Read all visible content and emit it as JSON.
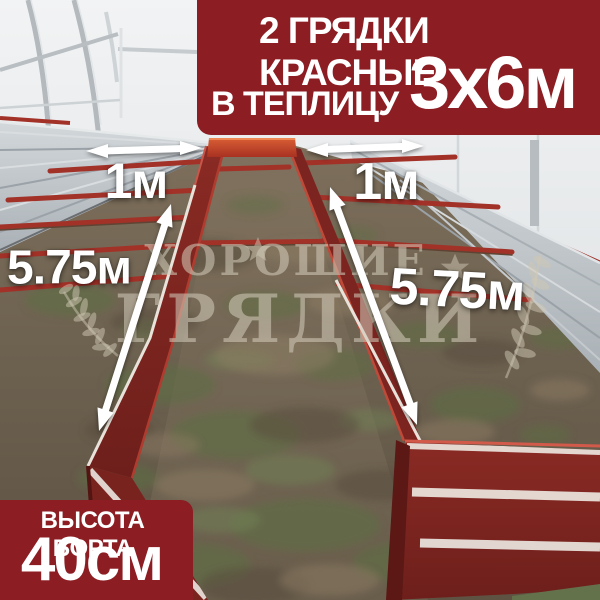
{
  "banner": {
    "line1": "2 ГРЯДКИ КРАСНЫЕ",
    "line2_prefix": "В ТЕПЛИЦУ",
    "line2_size": "3х6м",
    "bg_color": "#8c1d23",
    "text_color": "#ffffff"
  },
  "badge": {
    "line1": "ВЫСОТА БОРТА",
    "line2": "40см",
    "bg_color": "#8c1d23",
    "text_color": "#ffffff"
  },
  "measurements": {
    "left_bed_width": "1м",
    "right_bed_width": "1м",
    "left_bed_length": "5.75м",
    "right_bed_length": "5.75м"
  },
  "watermark": {
    "line1": "ХОРОШИЕ",
    "line2": "ГРЯДКИ"
  },
  "photo_colors": {
    "bed_red": "#7c2420",
    "bar_red": "#a23128",
    "galvanized": "#c3c9cd",
    "soil": "#6f6350",
    "grass": "#5d6e44",
    "wall": "#e9ecee",
    "arrow_white": "#ffffff"
  }
}
